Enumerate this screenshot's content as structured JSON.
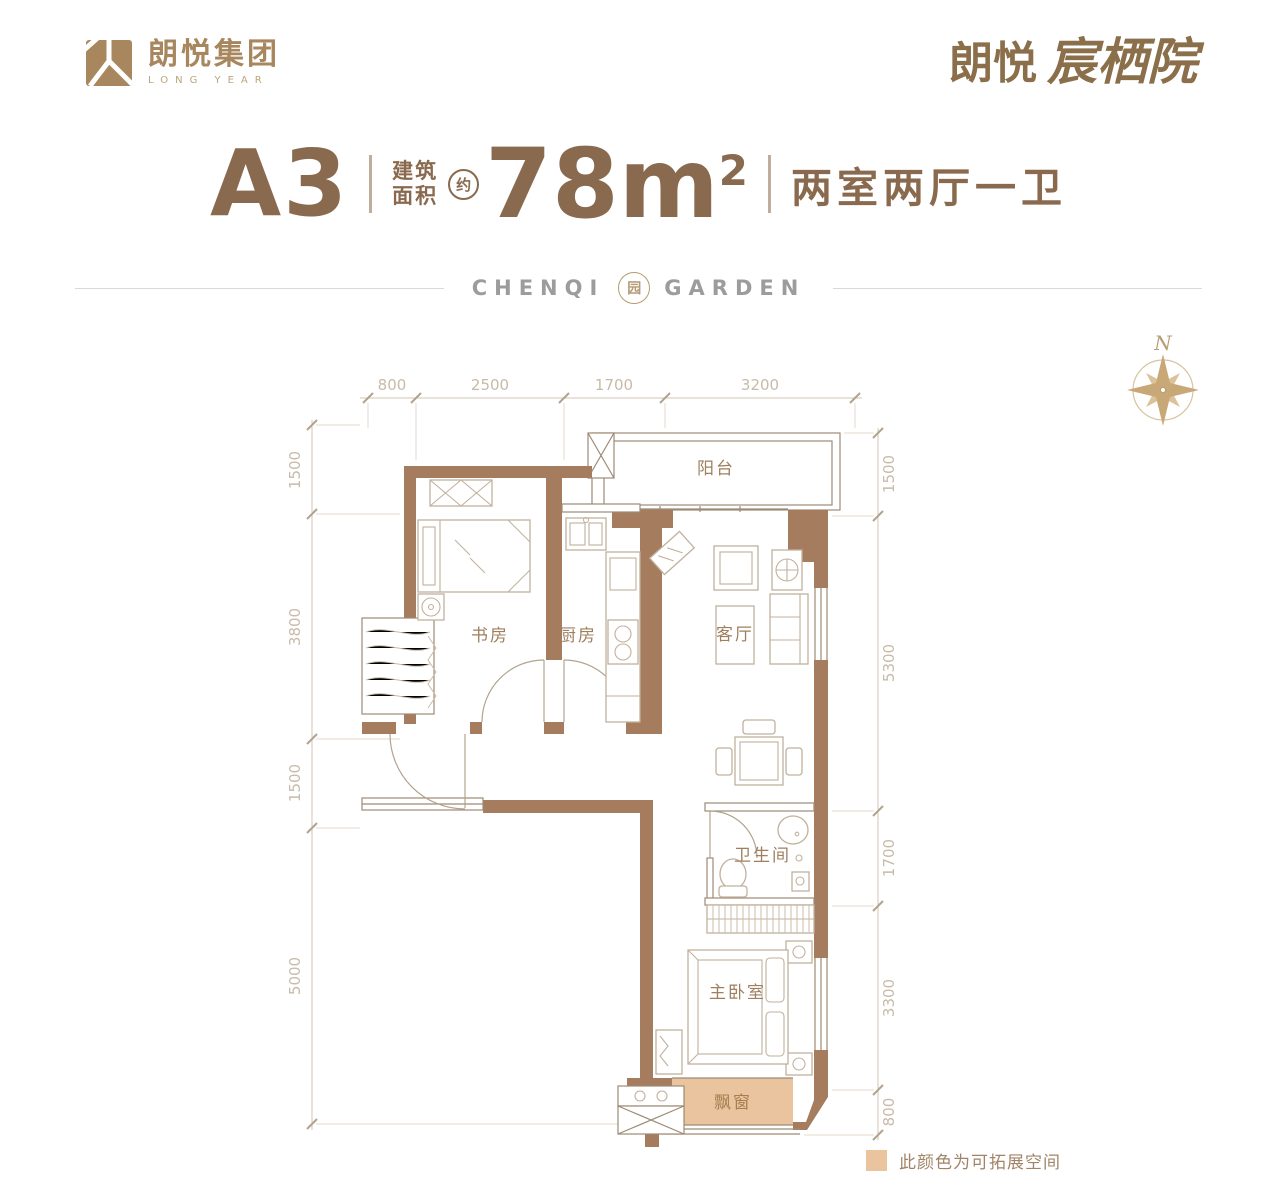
{
  "header": {
    "logo_left": {
      "company": "朗悦集团",
      "tagline": "LONG YEAR"
    },
    "logo_right": {
      "brand": "朗悦",
      "project": "宸栖院"
    }
  },
  "title_block": {
    "unit": "A3",
    "area_prefix_line1": "建筑",
    "area_prefix_line2": "面积",
    "approx_badge": "约",
    "area_number": "78",
    "area_unit": "m",
    "area_exponent": "2",
    "layout_summary": "两室两厅一卫"
  },
  "brand_divider": {
    "word_left": "CHENQI",
    "word_right": "GARDEN",
    "seal_char": "园"
  },
  "compass": {
    "north_label": "N"
  },
  "floor_plan": {
    "rooms": {
      "study": "书房",
      "kitchen": "厨房",
      "living": "客厅",
      "balcony": "阳台",
      "bathroom": "卫生间",
      "master_bedroom": "主卧室",
      "bay_window": "飘窗"
    },
    "dimensions_top": [
      "800",
      "2500",
      "1700",
      "3200"
    ],
    "dimensions_left": [
      "1500",
      "3800",
      "1500",
      "5000"
    ],
    "dimensions_right": [
      "1500",
      "5300",
      "1700",
      "3300",
      "800"
    ]
  },
  "legend": {
    "text": "此颜色为可拓展空间",
    "swatch_color": "#e9c49e"
  },
  "colors": {
    "wall": "#a67c5e",
    "structure_line": "#9d8a74",
    "furniture_line": "#c1b19d",
    "accent_text": "#8a6a4f",
    "dimension_text": "#c8baa8",
    "bay_fill": "#e9c49e",
    "brand_gray": "#9c9c9c",
    "logo_brown": "#a8875f"
  }
}
